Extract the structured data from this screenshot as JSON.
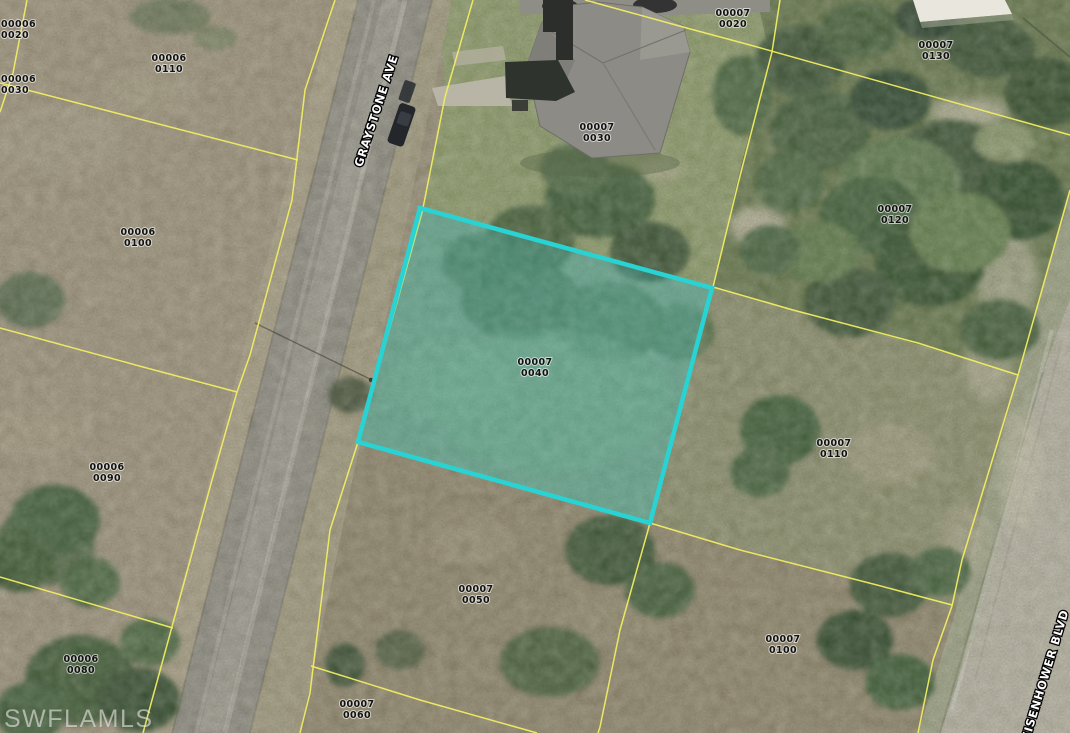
{
  "app": {
    "watermark": "SWFLAMLS"
  },
  "map": {
    "type": "aerial-parcel-map",
    "highlight_color": "#29d3d3",
    "boundary_color": "#f1ed62",
    "streets": [
      {
        "name": "GRAYSTONE AVE"
      },
      {
        "name": "EISENHOWER BLVD"
      }
    ],
    "highlighted_parcel": {
      "block": "00007",
      "lot": "0040"
    },
    "parcels": [
      {
        "block": "00006",
        "lot": "0020"
      },
      {
        "block": "00006",
        "lot": "0030"
      },
      {
        "block": "00006",
        "lot": "0110"
      },
      {
        "block": "00006",
        "lot": "0100"
      },
      {
        "block": "00006",
        "lot": "0090"
      },
      {
        "block": "00006",
        "lot": "0080"
      },
      {
        "block": "00007",
        "lot": "0020"
      },
      {
        "block": "00007",
        "lot": "0030"
      },
      {
        "block": "00007",
        "lot": "0130"
      },
      {
        "block": "00007",
        "lot": "0120"
      },
      {
        "block": "00007",
        "lot": "0040",
        "highlighted": true
      },
      {
        "block": "00007",
        "lot": "0110"
      },
      {
        "block": "00007",
        "lot": "0050"
      },
      {
        "block": "00007",
        "lot": "0100"
      },
      {
        "block": "00007",
        "lot": "0060"
      }
    ]
  }
}
